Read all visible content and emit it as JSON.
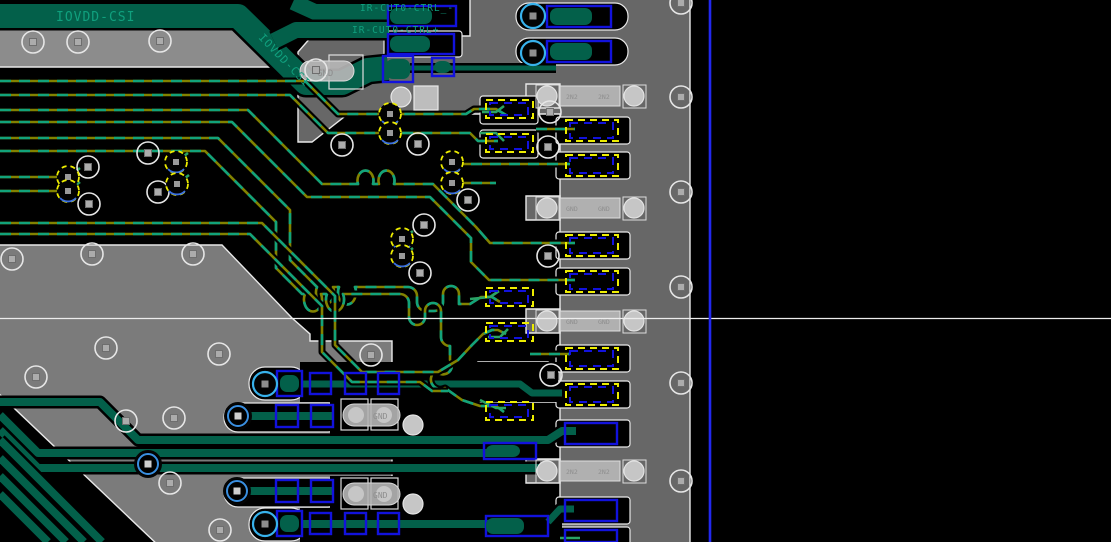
{
  "app": {
    "view_width": 1111,
    "view_height": 542,
    "description": "PCB layout editor viewport"
  },
  "labels": {
    "iovdd_top": "IOVDD-CSI",
    "iovdd_diag": "IOVDD-CSI",
    "ir_ctrl_minus": "IR-CUT0-CTRL_-",
    "ir_ctrl_plus": "IR-CUT0-CTRL+",
    "gnd": "GND"
  },
  "nets_visible": [
    "IOVDD-CSI",
    "IR-CUT0-CTRL_-",
    "IR-CUT0-CTRL+",
    "GND"
  ],
  "colors": {
    "bg": "#000000",
    "pour_top": "#8C8C8C",
    "pour_left": "#7B7B7B",
    "pour_right": "#676767",
    "edge": "#E8E8E8",
    "dark_green": "#03604A",
    "bright_green": "#2AA365",
    "teal_dash": "#12A37B",
    "olive": "#828200",
    "blue_pad": "#1212DD",
    "yellow": "#EDED00",
    "cyan_via": "#38B2EC",
    "blue_via": "#3A8FE0",
    "comp_body": "#B6B6B6",
    "comp_pad": "#C6C6C6",
    "comp_text": "#8E8E8E",
    "label_green": "#10A07E",
    "crosshair": "#EDEDED",
    "guide_blue": "#2228EE"
  },
  "components": [
    {
      "row_y": 83,
      "pad_labels": [
        "2N2",
        "2N2"
      ]
    },
    {
      "row_y": 195,
      "pad_labels": [
        "GND",
        "GND"
      ]
    },
    {
      "row_y": 308,
      "pad_labels": [
        "GND",
        "GND"
      ]
    },
    {
      "row_y": 458,
      "pad_labels": [
        "2N2",
        "2N2"
      ]
    },
    {
      "at": "band-bend",
      "pad_labels": [
        "GND"
      ]
    },
    {
      "at": "bottom-row-1",
      "pad_labels": [
        "GND"
      ]
    },
    {
      "at": "bottom-row-2",
      "pad_labels": [
        "GND"
      ]
    }
  ],
  "scene": {
    "pours": [
      {
        "pts": "-5,25 232,25 272,67 -5,67",
        "c": "pour_top",
        "s": 1,
        "n": "top-copper-strip"
      },
      {
        "pts": "-5,245 222,245 292,318 310,334 310,341 392,341 392,547 -5,547",
        "c": "pour_left",
        "s": 1,
        "n": "left-copper-pour"
      },
      {
        "pts": "312,36 470,36 470,-5 690,-5 690,547 560,547 560,114 348,114 312,142 298,142 298,52",
        "c": "pour_right",
        "s": 1,
        "n": "right-copper-pour"
      },
      {
        "pts": "478,362 548,362 560,372 560,402 478,402",
        "c": "pour_right",
        "s": 1,
        "n": "pour-tab"
      },
      {
        "pts": "526,84 560,84 560,108 526,108",
        "c": "pour_right",
        "s": 1,
        "n": "pour-tab"
      },
      {
        "pts": "526,196 560,196 560,220 526,220",
        "c": "pour_right",
        "s": 1,
        "n": "pour-tab"
      },
      {
        "pts": "526,309 560,309 560,333 526,333",
        "c": "pour_right",
        "s": 1,
        "n": "pour-tab"
      },
      {
        "pts": "526,459 560,459 560,483 526,483",
        "c": "pour_right",
        "s": 1,
        "n": "pour-tab"
      },
      {
        "pts": "-5,390 160,547 -5,547",
        "c": "bg",
        "s": 1,
        "n": "pour-void-wedge"
      }
    ],
    "cavities": [
      [
        516,
        3,
        112,
        27,
        13,
        1
      ],
      [
        516,
        38,
        112,
        27,
        13,
        1
      ],
      [
        556,
        117,
        74,
        27,
        3,
        1
      ],
      [
        556,
        152,
        74,
        27,
        3,
        1
      ],
      [
        556,
        232,
        74,
        27,
        3,
        1
      ],
      [
        556,
        268,
        74,
        27,
        3,
        1
      ],
      [
        556,
        345,
        74,
        27,
        3,
        1
      ],
      [
        556,
        381,
        74,
        27,
        3,
        1
      ],
      [
        556,
        420,
        74,
        27,
        3,
        1
      ],
      [
        556,
        497,
        74,
        27,
        3,
        1
      ],
      [
        556,
        527,
        74,
        18,
        3,
        1
      ],
      [
        249,
        367,
        58,
        33,
        16,
        1
      ],
      [
        224,
        403,
        118,
        29,
        14,
        1
      ],
      [
        224,
        478,
        118,
        29,
        14,
        1
      ],
      [
        249,
        508,
        58,
        33,
        16,
        1
      ],
      [
        300,
        362,
        258,
        40,
        0,
        0
      ],
      [
        330,
        398,
        132,
        38,
        0,
        0
      ],
      [
        330,
        476,
        132,
        38,
        0,
        0
      ],
      [
        300,
        508,
        262,
        34,
        0,
        0
      ],
      [
        480,
        96,
        58,
        28,
        3,
        1
      ],
      [
        480,
        130,
        58,
        28,
        3,
        1
      ],
      [
        384,
        31,
        78,
        26,
        3,
        1
      ]
    ],
    "thick": [
      {
        "d": "M0,16 H238 L306,83 H342 L368,70 L388,68",
        "w": 24,
        "n": "net-band-iovdd-csi"
      },
      {
        "d": "M293,2 L315,12 H388",
        "w": 16,
        "n": "net-band-ir-cut0-ctrl-minus"
      },
      {
        "d": "M274,41 L296,30 H388",
        "w": 16,
        "n": "net-band-ir-cut0-ctrl-plus"
      },
      {
        "d": "M410,68 H556",
        "w": 5
      },
      {
        "d": "M0,402 H100 L138,440 H548 L562,431 H576",
        "w": 8
      },
      {
        "d": "M0,415 L38,453 H505",
        "w": 8
      },
      {
        "d": "M0,430 L38,468 H540",
        "w": 8
      },
      {
        "d": "M0,440 L102,542",
        "w": 8
      },
      {
        "d": "M0,458 L84,542",
        "w": 8
      },
      {
        "d": "M0,476 L66,542",
        "w": 8
      },
      {
        "d": "M0,494 L48,542",
        "w": 8
      },
      {
        "d": "M247,416 H332",
        "w": 8
      },
      {
        "d": "M247,491 H332",
        "w": 8
      },
      {
        "d": "M302,524 H500",
        "w": 8
      },
      {
        "d": "M302,384 H520 L532,393 H562",
        "w": 7
      },
      {
        "d": "M548,522 L560,509 H574",
        "w": 7
      }
    ],
    "routes": [
      {
        "d": "M0,81 H305 L338,114 H466 L474,109 H496 l10,6"
      },
      {
        "d": "M0,95 H290 L328,133 H470 l8,8 H498"
      },
      {
        "d": "M0,110 H248 L322,184 H358 A8,10 0 1 1 373,184 H379 A8,10 0 1 1 394,184 H433 L476,227 L490,243 H575"
      },
      {
        "d": "M0,122 H232 L307,197 H430 L471,238 V262 L489,280 H575"
      },
      {
        "d": "M0,138 H218 L290,210 V260 L317,287 A9,12 0 1 0 333,287 H339 A9,12 0 1 0 355,287 H408 A9,9 0 0 1 417,296 V302 A9,9 0 0 0 426,311 H434 A9,9 0 0 0 443,302 V294 A8,8 0 0 1 459,294 V304 L470,304 L481,297 H492 l8,5"
      },
      {
        "d": "M0,151 H205 L276,222 V268 L302,294 H305 A9,12 0 1 0 321,294 H327 A9,12 0 1 0 343,294 H400 A9,9 0 0 1 409,303 V317 A8,8 0 0 0 425,317 V311 A8,8 0 0 1 441,311 V337 A9,9 0 0 0 450,346 V360 A8,8 0 0 1 436,371 A9,9 0 0 0 445,388 L462,400 L480,406 H496 l8,6"
      },
      {
        "d": "M0,223 H262 L335,296 V345 L362,372 H438 L458,360 L472,345 L483,334 L492,330 h6 l8,4"
      },
      {
        "d": "M0,234 H250 L322,306 V352 L352,382 H420 L432,391 H448"
      },
      {
        "d": "M0,177 H60"
      },
      {
        "d": "M0,191 H62"
      },
      {
        "d": "M452,164 H570"
      },
      {
        "d": "M536,129 H575"
      },
      {
        "d": "M452,183 H496"
      },
      {
        "d": "M530,354 H570"
      }
    ],
    "stubs": [
      "M68,177 l12,-9",
      "M68,191 l12,-9",
      "M176,162 l12,-9",
      "M177,184 l12,-9",
      "M402,239 l11,-8",
      "M402,256 l11,-8",
      "M482,112 l14,0 l8,-6",
      "M480,133 l16,0 l8,8",
      "M470,299 l20,-2 l9,-6",
      "M488,337 l12,0 l8,-8",
      "M480,400 l16,8 l10,0",
      "M560,538 h20"
    ],
    "pads_yellow": [
      [
        566,
        120,
        52,
        21
      ],
      [
        566,
        155,
        52,
        21
      ],
      [
        566,
        235,
        52,
        21
      ],
      [
        566,
        271,
        52,
        21
      ],
      [
        566,
        348,
        52,
        21
      ],
      [
        566,
        384,
        52,
        21
      ],
      [
        486,
        100,
        47,
        18
      ],
      [
        486,
        134,
        47,
        18
      ],
      [
        486,
        288,
        47,
        18
      ],
      [
        486,
        323,
        47,
        18
      ],
      [
        486,
        402,
        47,
        18
      ]
    ],
    "pads_blue_solid": [
      [
        547,
        6,
        64,
        21
      ],
      [
        547,
        41,
        64,
        21
      ],
      [
        565,
        423,
        52,
        21
      ],
      [
        565,
        500,
        52,
        21
      ],
      [
        565,
        530,
        52,
        12
      ],
      [
        484,
        443,
        52,
        16
      ],
      [
        486,
        516,
        62,
        20
      ],
      [
        388,
        6,
        68,
        20
      ],
      [
        388,
        34,
        66,
        20
      ],
      [
        383,
        56,
        30,
        26
      ],
      [
        432,
        58,
        22,
        18
      ],
      [
        277,
        371,
        25,
        25
      ],
      [
        277,
        511,
        25,
        25
      ]
    ],
    "pads_green_fill": [
      [
        550,
        8,
        42,
        17
      ],
      [
        550,
        43,
        42,
        17
      ],
      [
        390,
        8,
        42,
        16
      ],
      [
        390,
        36,
        40,
        16
      ],
      [
        386,
        59,
        24,
        20
      ],
      [
        434,
        61,
        17,
        12
      ],
      [
        280,
        375,
        19,
        17
      ],
      [
        280,
        515,
        19,
        17
      ],
      [
        486,
        518,
        38,
        16
      ],
      [
        486,
        445,
        34,
        12
      ]
    ],
    "squares_blue": [
      [
        310,
        373,
        21,
        21
      ],
      [
        345,
        373,
        21,
        21
      ],
      [
        378,
        373,
        21,
        21
      ],
      [
        276,
        405,
        22,
        22
      ],
      [
        311,
        405,
        22,
        22
      ],
      [
        276,
        480,
        22,
        22
      ],
      [
        311,
        480,
        22,
        22
      ],
      [
        310,
        513,
        21,
        21
      ],
      [
        345,
        513,
        21,
        21
      ],
      [
        378,
        513,
        21,
        21
      ]
    ],
    "strip_comps": [
      {
        "y": 83,
        "l": "2N2",
        "r": "2N2"
      },
      {
        "y": 195,
        "l": "GND",
        "r": "GND"
      },
      {
        "y": 308,
        "l": "GND",
        "r": "GND"
      },
      {
        "y": 458,
        "l": "2N2",
        "r": "2N2"
      }
    ],
    "gnd_comps": [
      {
        "x": 343,
        "y": 404,
        "label": "GND"
      },
      {
        "x": 343,
        "y": 483,
        "label": "GND"
      }
    ],
    "vias": {
      "white": [
        [
          33,
          42
        ],
        [
          78,
          42
        ],
        [
          160,
          41
        ],
        [
          88,
          167
        ],
        [
          89,
          204
        ],
        [
          148,
          153
        ],
        [
          158,
          192
        ],
        [
          342,
          145
        ],
        [
          418,
          144
        ],
        [
          468,
          200
        ],
        [
          424,
          225
        ],
        [
          420,
          273
        ],
        [
          12,
          259
        ],
        [
          92,
          254
        ],
        [
          193,
          254
        ],
        [
          106,
          348
        ],
        [
          36,
          377
        ],
        [
          219,
          354
        ],
        [
          371,
          355
        ],
        [
          126,
          421
        ],
        [
          174,
          418
        ],
        [
          170,
          483
        ],
        [
          220,
          530
        ],
        [
          550,
          112
        ],
        [
          548,
          147
        ],
        [
          548,
          256
        ],
        [
          551,
          375
        ],
        [
          681,
          3
        ],
        [
          681,
          97
        ],
        [
          681,
          192
        ],
        [
          681,
          287
        ],
        [
          681,
          383
        ],
        [
          681,
          481
        ],
        [
          316,
          70
        ]
      ],
      "yellow": [
        [
          68,
          177
        ],
        [
          68,
          191
        ],
        [
          176,
          162
        ],
        [
          177,
          184
        ],
        [
          390,
          114
        ],
        [
          390,
          133
        ],
        [
          452,
          162
        ],
        [
          452,
          183
        ],
        [
          402,
          239
        ],
        [
          402,
          256
        ]
      ],
      "cyan": [
        [
          533,
          16
        ],
        [
          533,
          53
        ],
        [
          265,
          384
        ],
        [
          265,
          524
        ]
      ],
      "blue": [
        [
          238,
          416
        ],
        [
          237,
          491
        ],
        [
          148,
          464
        ]
      ]
    },
    "guides": {
      "crosshair_y": 318.5,
      "blue_line_x": 710
    }
  }
}
